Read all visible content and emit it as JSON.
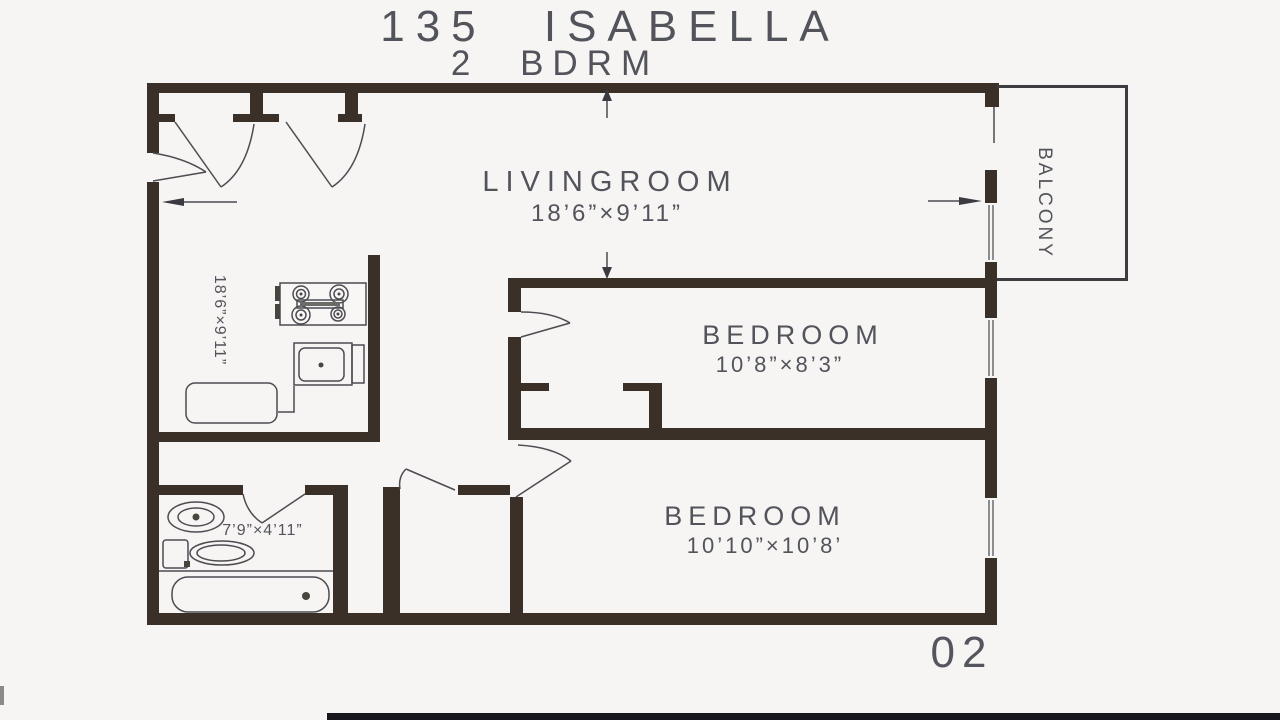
{
  "plan": {
    "title_line1": "135  ISABELLA",
    "title_line2": "2  BDRM",
    "livingroom": {
      "label": "LIVINGROOM",
      "dims": "18’6”×9’11”"
    },
    "bedroom_top": {
      "label": "BEDROOM",
      "dims": "10’8”×8’3”"
    },
    "bedroom_bottom": {
      "label": "BEDROOM",
      "dims": "10’10”×10’8’"
    },
    "kitchen": {
      "dims": "18’6”×9’11”"
    },
    "bathroom": {
      "dims": "7’9”×4’11”"
    },
    "balcony": {
      "label": "BALCONY"
    },
    "sheet_number": "02"
  },
  "colors": {
    "wall": "#3a3027",
    "linework": "#4c4c52",
    "text": "#53535b",
    "background": "#f6f5f3",
    "footer_bar": "#16161c"
  }
}
